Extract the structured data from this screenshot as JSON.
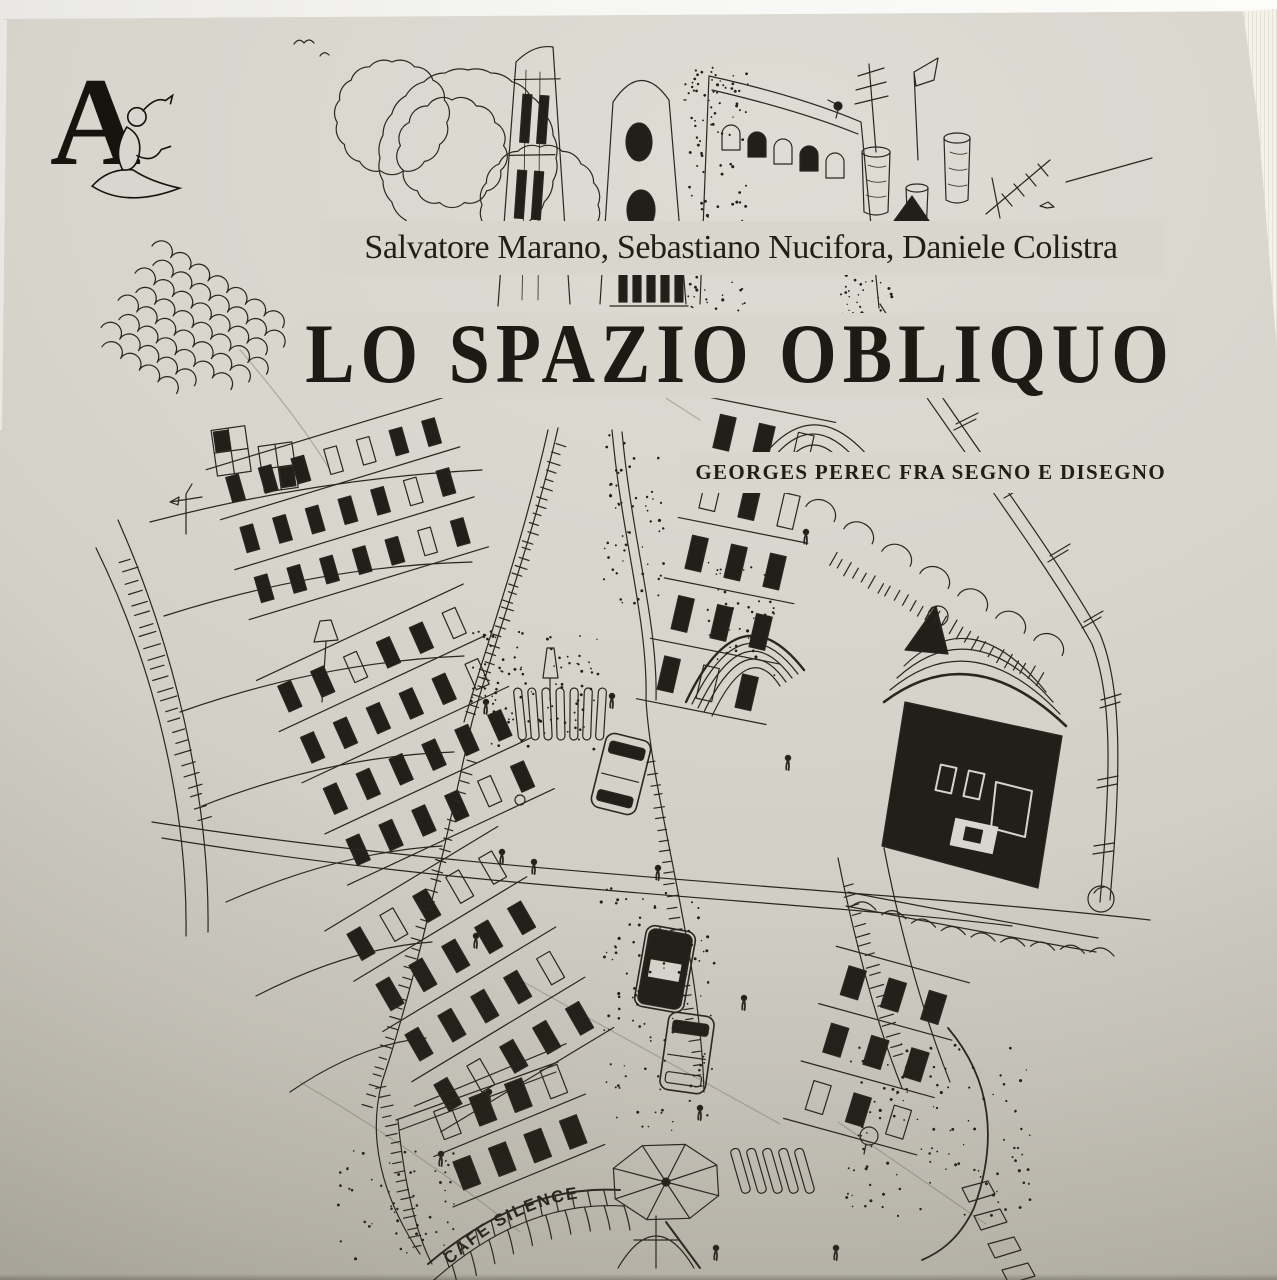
{
  "cover": {
    "publisher_logo_letter": "A",
    "authors": "Salvatore Marano, Sebastiano Nucifora, Daniele Colistra",
    "title": "LO SPAZIO OBLIQUO",
    "subtitle": "GEORGES PEREC FRA SEGNO E DISEGNO",
    "illustration": {
      "cafe_sign": "CAFE SILENCE",
      "description_style": "pen-and-ink aerial city drawing"
    },
    "colors": {
      "paper": "#d8d6ce",
      "ink": "#2a2620",
      "title_ink": "#1d1914",
      "photo_background": "#f3f2ef",
      "page_edge": "#eeebe0"
    }
  }
}
